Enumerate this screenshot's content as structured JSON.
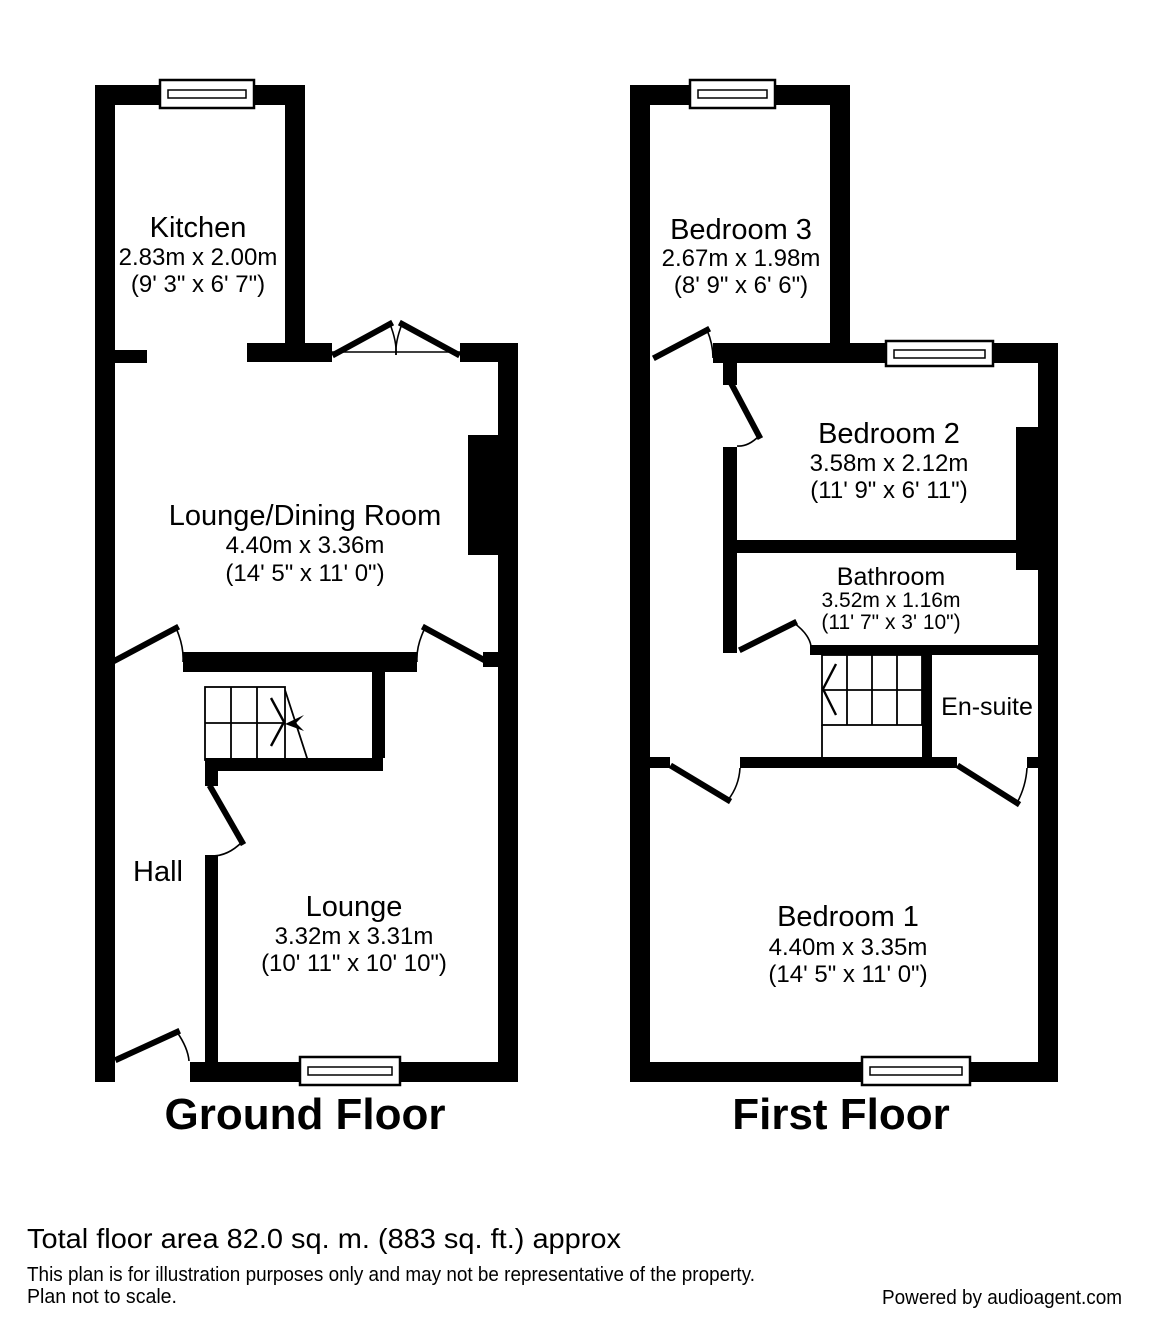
{
  "ground": {
    "title": "Ground Floor",
    "kitchen": {
      "name": "Kitchen",
      "metric": "2.83m x 2.00m",
      "imperial": "(9' 3\" x 6' 7\")"
    },
    "lounge_dining": {
      "name": "Lounge/Dining Room",
      "metric": "4.40m x 3.36m",
      "imperial": "(14' 5\" x 11' 0\")"
    },
    "hall": {
      "name": "Hall"
    },
    "lounge": {
      "name": "Lounge",
      "metric": "3.32m x 3.31m",
      "imperial": "(10' 11\" x 10' 10\")"
    }
  },
  "first": {
    "title": "First Floor",
    "bedroom3": {
      "name": "Bedroom 3",
      "metric": "2.67m x 1.98m",
      "imperial": "(8' 9\" x 6' 6\")"
    },
    "bedroom2": {
      "name": "Bedroom 2",
      "metric": "3.58m x 2.12m",
      "imperial": "(11' 9\" x 6' 11\")"
    },
    "bathroom": {
      "name": "Bathroom",
      "metric": "3.52m x 1.16m",
      "imperial": "(11' 7\" x 3' 10\")"
    },
    "ensuite": {
      "name": "En-suite"
    },
    "bedroom1": {
      "name": "Bedroom 1",
      "metric": "4.40m x 3.35m",
      "imperial": "(14' 5\" x 11' 0\")"
    }
  },
  "footer": {
    "total_area": "Total floor area 82.0 sq. m. (883 sq. ft.) approx",
    "disclaimer1": "This plan is for illustration purposes only and may not be representative of the property.",
    "disclaimer2": "Plan not to scale.",
    "powered_by": "Powered by audioagent.com"
  },
  "colors": {
    "walls": "#000000",
    "background": "#ffffff"
  }
}
